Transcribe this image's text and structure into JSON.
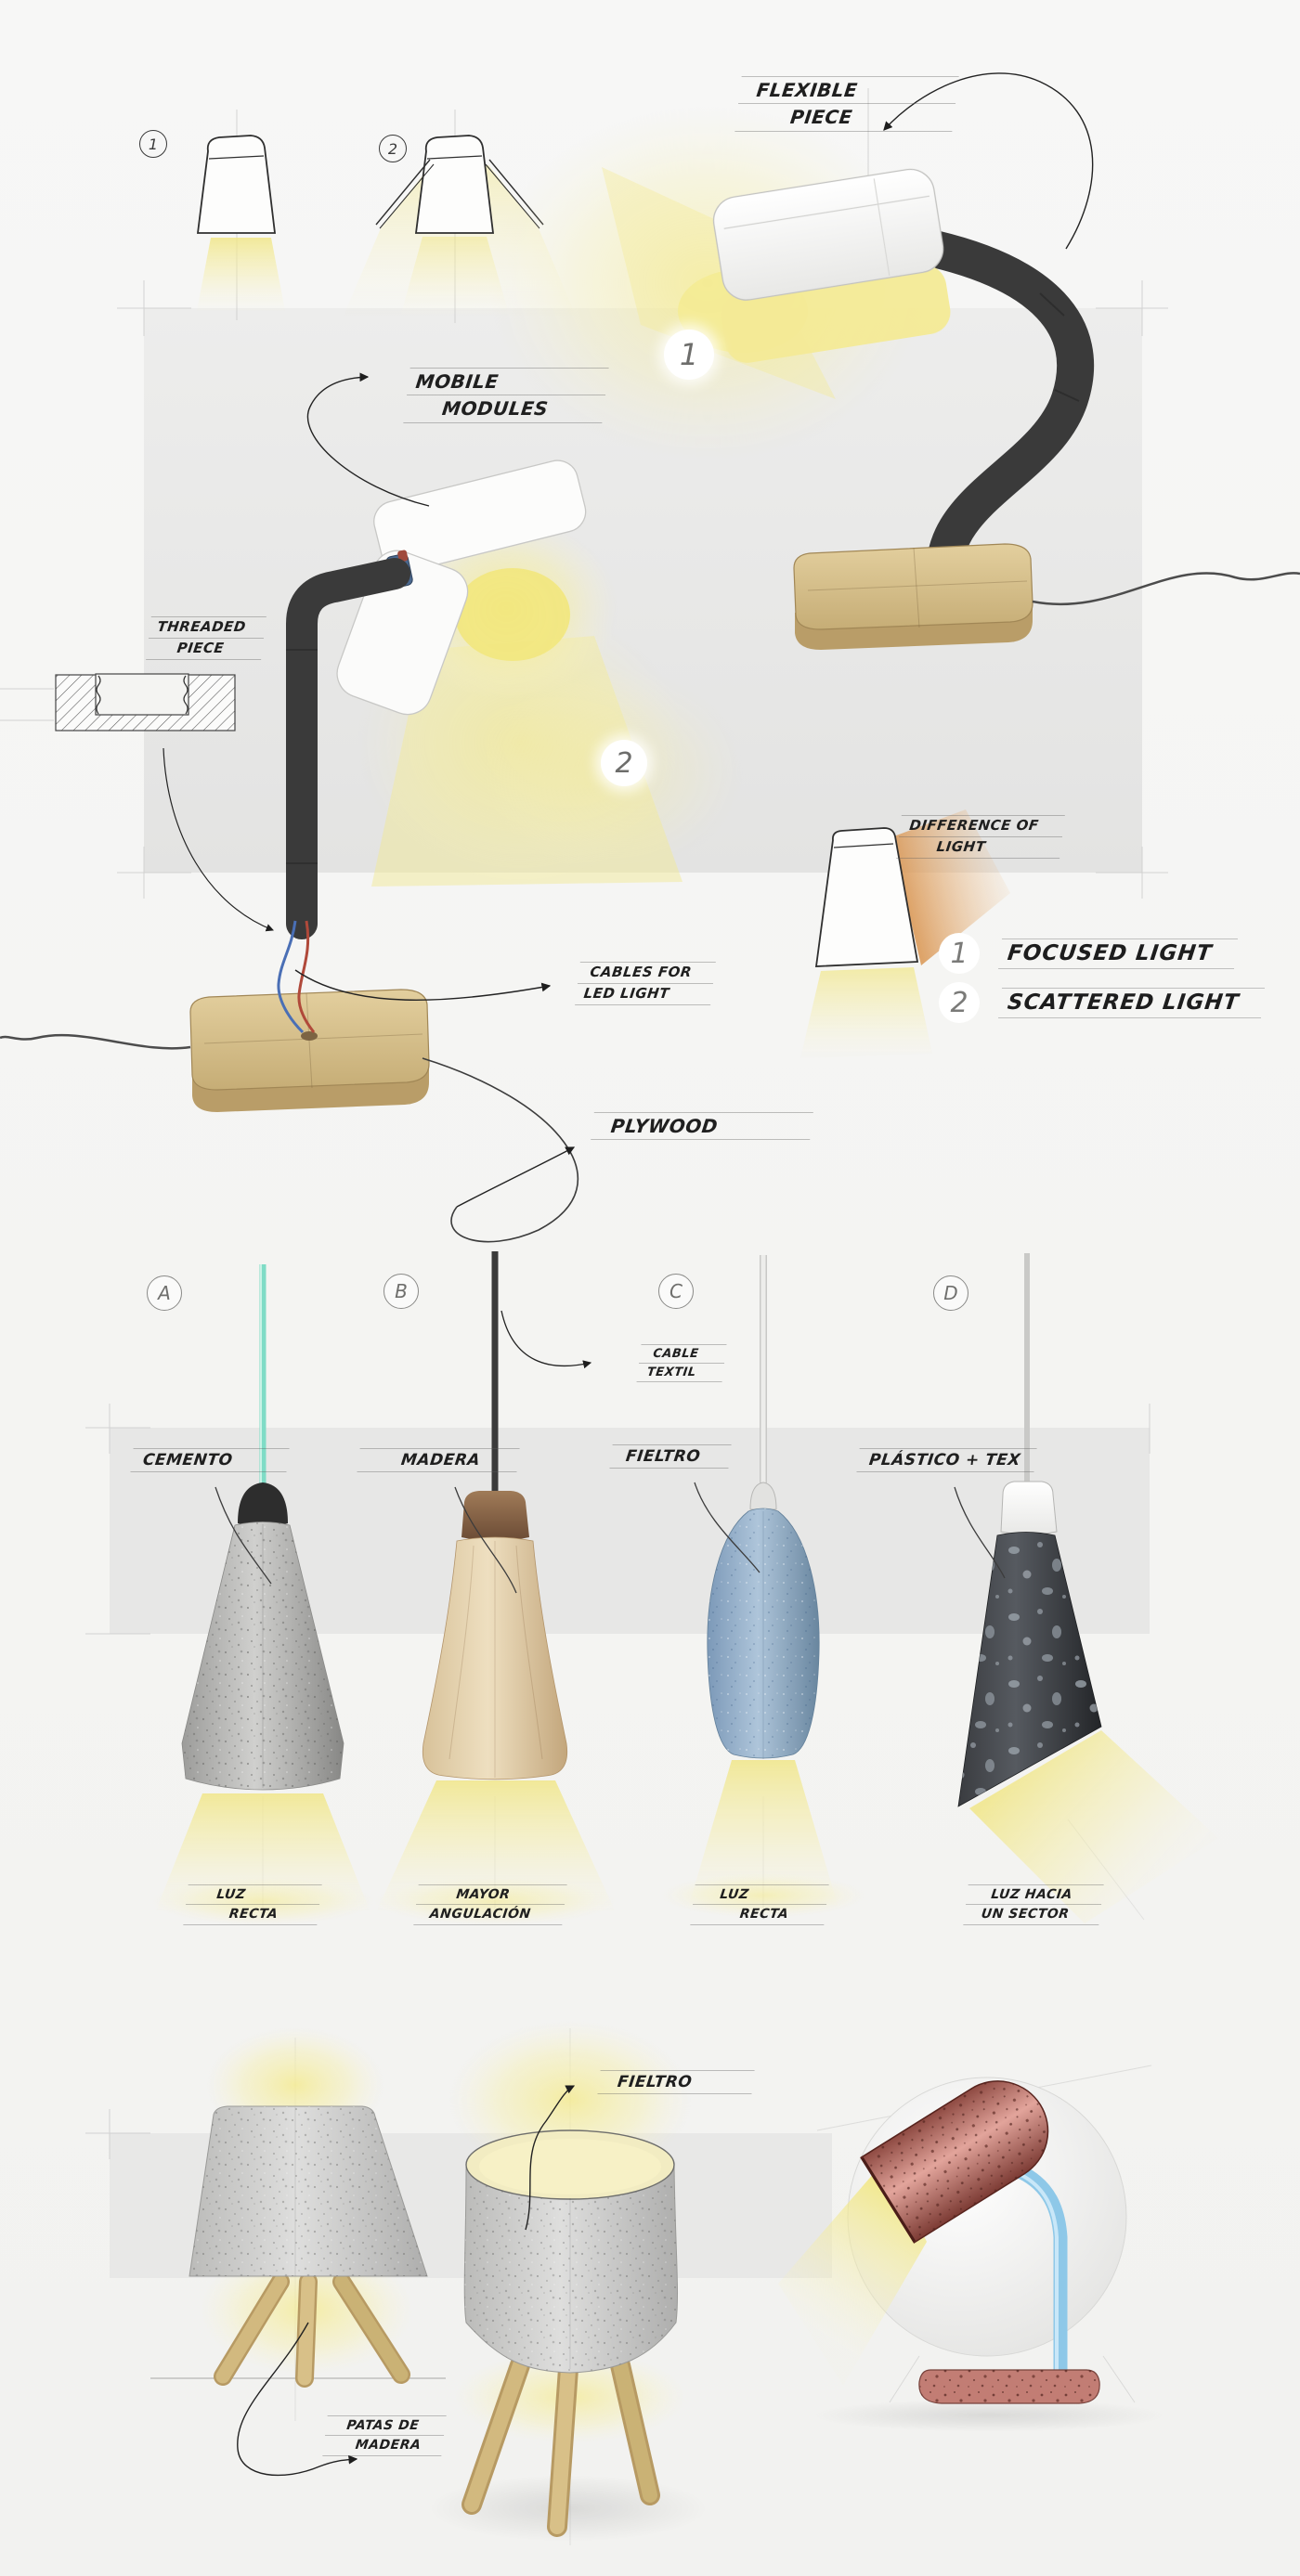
{
  "page": {
    "title": "Lamp design concept sketch sheet",
    "sections": [
      "table lamp with mobile modules",
      "pendant lamp material studies A-D",
      "tripod felt lamps and speckled desk lamp"
    ]
  },
  "labels": {
    "flexible": [
      "FLEXIBLE",
      "PIECE"
    ],
    "mobile": [
      "MOBILE",
      "MODULES"
    ],
    "threaded": [
      "THREADED",
      "PIECE"
    ],
    "difference": [
      "DIFFERENCE OF",
      "LIGHT"
    ],
    "cables": [
      "CABLES FOR",
      "LED LIGHT"
    ],
    "plywood": "PLYWOOD",
    "cable_textil": [
      "CABLE",
      "TEXTIL"
    ],
    "fieltro_bottom": "FIELTRO",
    "patas": [
      "PATAS DE",
      "MADERA"
    ]
  },
  "legend": {
    "items": [
      {
        "num": "1",
        "text": "FOCUSED LIGHT"
      },
      {
        "num": "2",
        "text": "SCATTERED LIGHT"
      }
    ]
  },
  "markers": {
    "sketch_1": "1",
    "sketch_2": "2",
    "view_1": "1",
    "view_2": "2"
  },
  "pendants": [
    {
      "letter": "A",
      "material": "CEMENTO",
      "caption": [
        "LUZ",
        "RECTA"
      ]
    },
    {
      "letter": "B",
      "material": "MADERA",
      "caption": [
        "MAYOR",
        "ANGULACIÓN"
      ]
    },
    {
      "letter": "C",
      "material": "FIELTRO",
      "caption": [
        "LUZ",
        "RECTA"
      ]
    },
    {
      "letter": "D",
      "material": "PLÁSTICO + TEX",
      "caption": [
        "LUZ HACIA",
        "UN SECTOR"
      ]
    }
  ],
  "colors": {
    "background": "#f5f5f3",
    "panel_gray": "#e8e8e7",
    "light_yellow": "#f3ea96",
    "plywood": "#d8c290",
    "tube_dark": "#3a3a3a",
    "concrete_gray": "#c0c0be",
    "wood_body": "#e2cda9",
    "wood_cap": "#85613f",
    "felt_blue": "#8fa9c2",
    "plastic_dark": "#3a3c40",
    "cable_teal": "#7fdcc6",
    "cable_black": "#3b3b3b",
    "cable_white": "#ededeb",
    "cable_gray": "#c9c9c7",
    "lamp_red": "#c27d74",
    "stem_blue": "#8ec8e8",
    "felt_gray": "#c9c9c7",
    "ink": "#1f1f1f"
  }
}
